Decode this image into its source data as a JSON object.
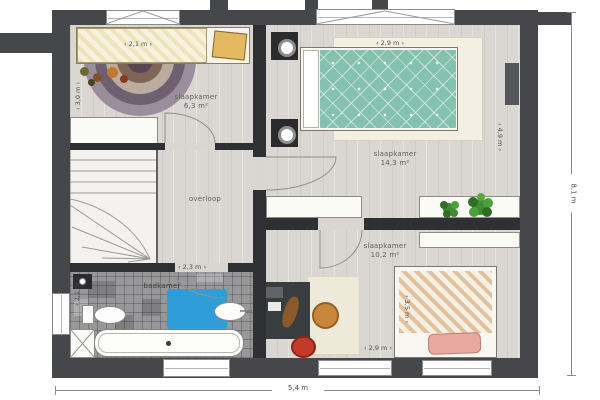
{
  "plan": {
    "type": "floor-plan",
    "floor_name": "verdieping (upper floor)",
    "rooms": {
      "bedroom1": {
        "label": "slaapkamer",
        "area": "6,3 m²"
      },
      "bedroom2": {
        "label": "slaapkamer",
        "area": "14,3 m²"
      },
      "bedroom3": {
        "label": "slaapkamer",
        "area": "10,2 m²"
      },
      "bathroom": {
        "label": "badkamer"
      },
      "landing": {
        "label": "overloop"
      }
    },
    "dimensions": {
      "bedroom1_width": "2,1 m",
      "bedroom1_depth": "3,0 m",
      "bedroom2_width": "2,9 m",
      "bedroom2_depth": "4,9 m",
      "bedroom3_width": "2,9 m",
      "bedroom3_depth": "3,5 m",
      "bathroom_width": "2,3 m",
      "bathroom_depth": "2,1 m",
      "total_width": "5,4 m",
      "total_height": "8,1 m"
    },
    "colors": {
      "wall": "#46474b",
      "interior_wall": "#2e3034",
      "floor": "#dad6d1",
      "master_bed_teal": "#84c2af",
      "bath_mat_blue": "#2f9ed8",
      "beanbag_red": "#c23a2a",
      "chair_orange": "#c9873b",
      "plant_green": "#3f8c33"
    }
  }
}
